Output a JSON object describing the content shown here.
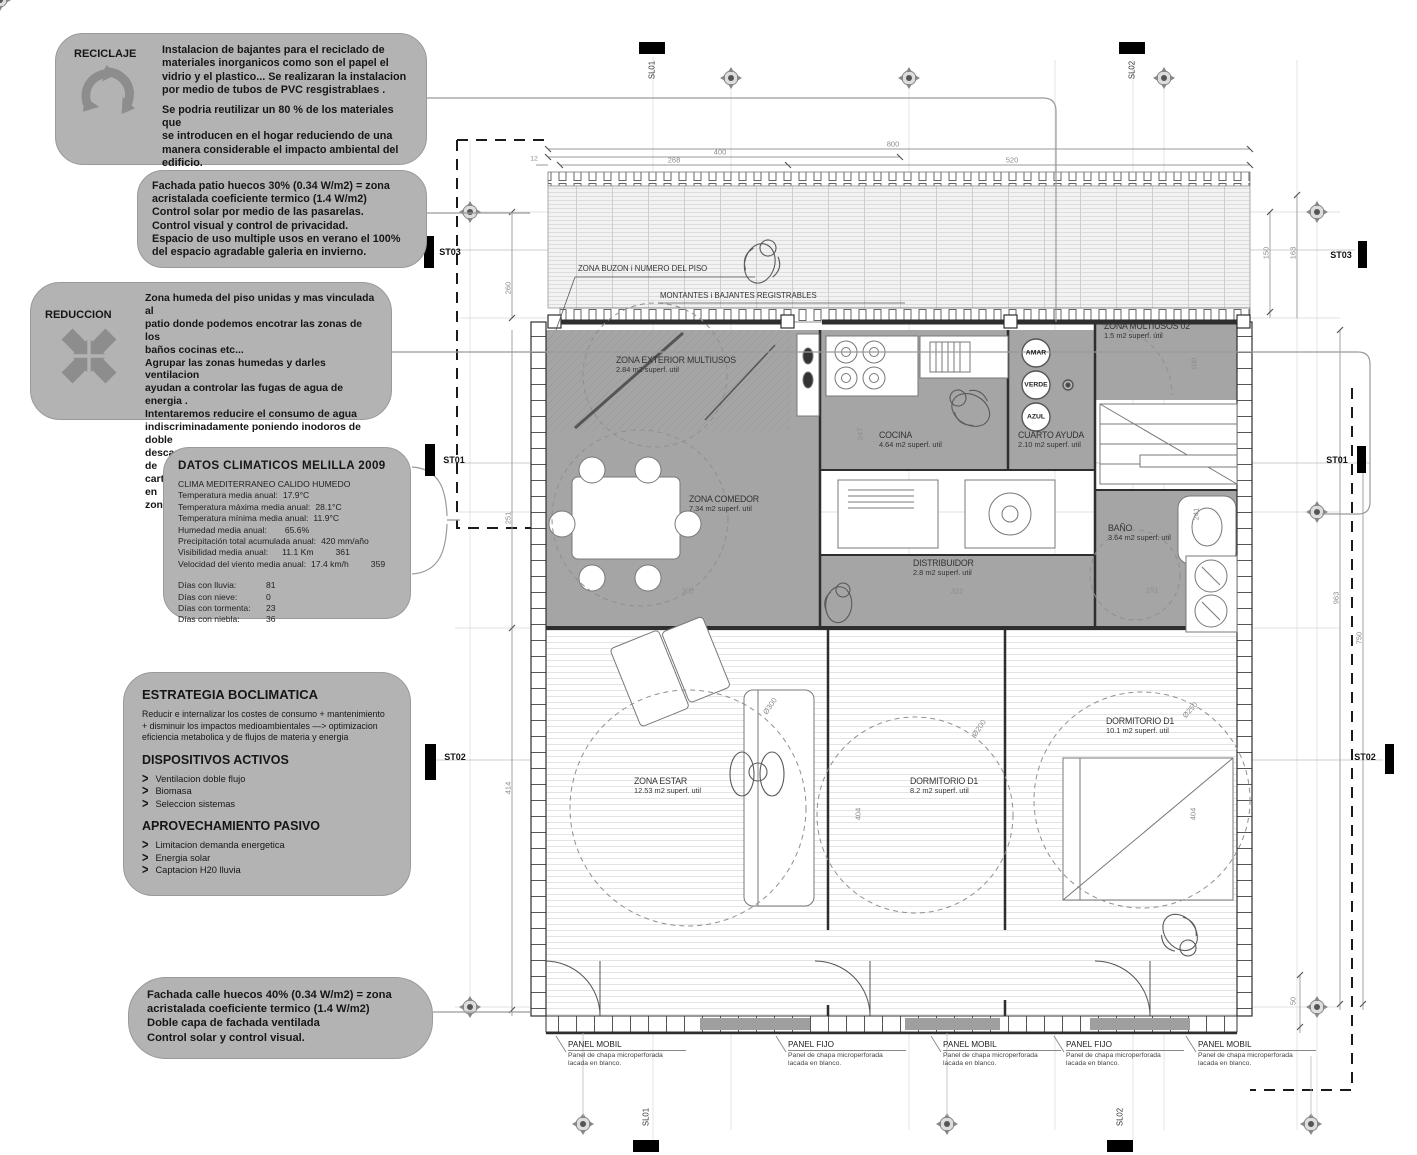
{
  "colors": {
    "callout_bg": "#b3b3b3",
    "callout_icon": "#8d8d8d",
    "room_fill": "#a5a5a5",
    "wall": "#2e2e2e",
    "dim": "#8c8c8c"
  },
  "callouts": {
    "reciclaje": {
      "title": "RECICLAJE",
      "p1": "Instalacion de bajantes para el reciclado de\nmateriales inorganicos como son el papel el\nvidrio y el plastico... Se realizaran la  instalacion\npor medio de tubos de PVC resgistrablaes .",
      "p2": "Se podria reutilizar un 80 % de los materiales que\nse introducen en el hogar reduciendo de una\nmanera considerable el impacto ambiental del\nedificio."
    },
    "fachada_patio": {
      "text": "Fachada patio huecos 30% (0.34 W/m2) = zona\nacristalada coeficiente termico (1.4 W/m2)\nControl solar por medio de las pasarelas.\nControl visual  y control de privacidad.\nEspacio de uso multiple usos en verano el 100%\ndel espacio agradable galeria en invierno."
    },
    "reduccion": {
      "title": "REDUCCION",
      "text": "Zona humeda del piso unidas y  mas vinculada al\npatio donde podemos encotrar las zonas de los\nbaños cocinas etc...\nAgrupar las zonas humedas y darles ventilacion\nayudan a controlar las fugas de agua de energia .\nIntentaremos reducire el consumo de agua\nindiscriminadamente poniendo inodoros de doble\ndescarga aparatos de bajo consumo , griferias de\ncartucho ecologicos y detectores de presncia en\nzonas comunes."
    },
    "datos": {
      "title": "DATOS  CLIMATICOS  MELILLA  2009",
      "clima": "CLIMA MEDITERRANEO CALIDO HUMEDO",
      "stats": [
        {
          "label": "Temperatura media anual:",
          "value": "17.9°C",
          "extra": ""
        },
        {
          "label": "Temperatura máxima media anual:",
          "value": "28.1°C",
          "extra": ""
        },
        {
          "label": "Temperatura mínima media anual:",
          "value": "11.9°C",
          "extra": ""
        },
        {
          "label": "Humedad media anual:",
          "value": "65.6%",
          "extra": ""
        },
        {
          "label": "Precipitación total acumulada anual:",
          "value": "420 mm/año",
          "extra": ""
        },
        {
          "label": "Visibilidad media anual:",
          "value": "11.1 Km",
          "extra": "361"
        },
        {
          "label": "Velocidad del viento media anual:",
          "value": "17.4 km/h",
          "extra": "359"
        }
      ],
      "dias": [
        {
          "label": "Días con lluvia:",
          "value": "81"
        },
        {
          "label": "Días con nieve:",
          "value": "0"
        },
        {
          "label": "Días con tormenta:",
          "value": "23"
        },
        {
          "label": "Días con niebla:",
          "value": "36"
        }
      ]
    },
    "estrategia": {
      "title": "ESTRATEGIA BOCLIMATICA",
      "intro": "Reducir e internalizar los costes de consumo  +  mantenimiento\n+  disminuir los impactos medioambientales  —>  optimizacion\neficiencia metabolica y de flujos de materia y energia",
      "activos_title": "DISPOSITIVOS ACTIVOS",
      "activos": [
        "Ventilacion doble flujo",
        "Biomasa",
        "Seleccion sistemas"
      ],
      "pasivo_title": "APROVECHAMIENTO PASIVO",
      "pasivo": [
        "Limitacion demanda energetica",
        "Energia solar",
        "Captacion H20 lluvia"
      ]
    },
    "fachada_calle": {
      "text": "Fachada calle huecos  40% (0.34 W/m2) = zona\nacristalada coeficiente termico (1.4 W/m2)\nDoble capa de fachada ventilada\nControl solar y control visual."
    }
  },
  "plan": {
    "annotations": {
      "buzon": "ZONA BUZON  i NUMERO DEL PISO",
      "montantes": "MONTANTES i BAJANTES REGISTRABLES"
    },
    "rooms": [
      {
        "name": "ZONA EXTERIOR MULTIUSOS",
        "area": "2.84 m2  superf. util"
      },
      {
        "name": "COCINA",
        "area": "4.64 m2  superf. util"
      },
      {
        "name": "CUARTO AYUDA",
        "area": "2.10 m2  superf. util"
      },
      {
        "name": "ZONA MULTIUSOS 02",
        "area": "1.5 m2  superf. útil"
      },
      {
        "name": "ZONA COMEDOR",
        "area": "7.34 m2  superf. util"
      },
      {
        "name": "DISTRIBUIDOR",
        "area": "2.8 m2  superf. util"
      },
      {
        "name": "BAÑO",
        "area": "3.64 m2  superf. util"
      },
      {
        "name": "ZONA ESTAR",
        "area": "12.53 m2  superf. util"
      },
      {
        "name": "DORMITORIO  D1",
        "area": "8.2 m2  superf. util"
      },
      {
        "name": "DORMITORIO  D1",
        "area": "10.1 m2  superf. util"
      }
    ],
    "risers": [
      "AMAR",
      "VERDE",
      "AZUL"
    ],
    "markers": {
      "st01": "ST01",
      "st02": "ST02",
      "st03": "ST03",
      "sl01": "SL01",
      "sl02": "SL02"
    },
    "dimensions": {
      "top": [
        "12",
        "268",
        "400",
        "800",
        "520"
      ],
      "left": [
        "260",
        "251",
        "414"
      ],
      "right": [
        "150",
        "163",
        "963",
        "750",
        "50"
      ],
      "inner": [
        "247",
        "100",
        "241",
        "151",
        "302",
        "322",
        "404",
        "404",
        "Ø300",
        "Ø200",
        "Ø250"
      ]
    },
    "panels": [
      {
        "title": "PANEL MOBIL",
        "desc": "Panel de chapa microperforada\nlacada en blanco."
      },
      {
        "title": "PANEL  FIJO",
        "desc": "Panel de chapa microperforada\nlacada en blanco."
      },
      {
        "title": "PANEL MOBIL",
        "desc": "Panel de chapa microperforada\nlacada en blanco."
      },
      {
        "title": "PANEL  FIJO",
        "desc": "Panel de chapa microperforada\nlacada en blanco."
      },
      {
        "title": "PANEL MOBIL",
        "desc": "Panel de chapa microperforada\nlacada en blanco."
      }
    ]
  }
}
